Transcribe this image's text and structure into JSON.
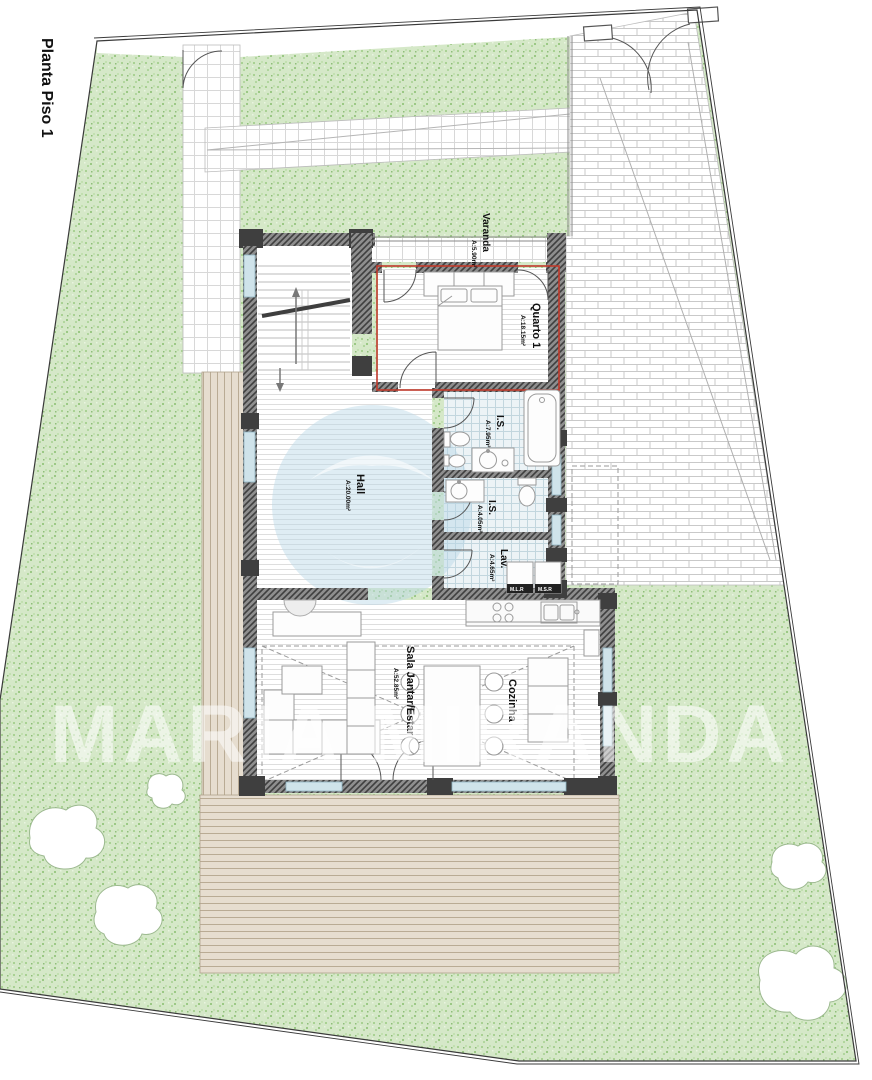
{
  "title": "Planta Piso 1",
  "rooms": {
    "varanda": {
      "name": "Varanda",
      "area": "A:5.90m²"
    },
    "quarto1": {
      "name": "Quarto 1",
      "area": "A:18.15m²"
    },
    "is1": {
      "name": "I.S.",
      "area": "A:7.95m²"
    },
    "is2": {
      "name": "I.S.",
      "area": "A:4.05m²"
    },
    "lav": {
      "name": "Lav.",
      "area": "A:4.65m²"
    },
    "hall": {
      "name": "Hall",
      "area": "A:20.00m²"
    },
    "sala": {
      "name": "Sala Jantar/Estar",
      "area": "A:52.85m²"
    },
    "cozinha": {
      "name": "Cozinha"
    }
  },
  "appliances": {
    "mlr": "M.L.R",
    "msr": "M.S.R"
  },
  "watermark": {
    "text": "MARIA MIRANDA S",
    "fragment_top": "7/AM"
  },
  "colors": {
    "grass": "#d5e8c8",
    "wall_hatch": "#8e8e8e",
    "wall_dark": "#3f3f3f",
    "room_outline_red": "#c0392b",
    "deck_wood": "#e6ddcf",
    "bath_tile": "#ecf3f6",
    "glazing": "#cfe3ea",
    "watermark_blue": "#b9d6e6",
    "watermark_white": "#ffffff"
  }
}
